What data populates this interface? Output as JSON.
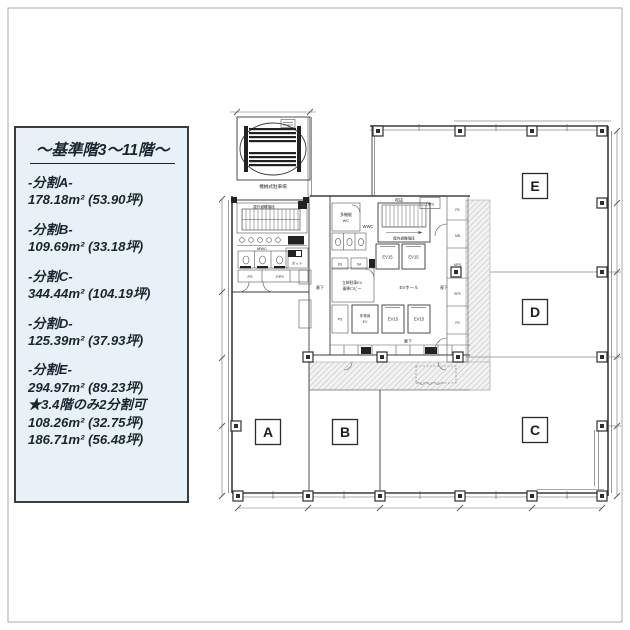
{
  "legend": {
    "title": "～基準階3～11階～",
    "items": [
      {
        "name": "-分割A-",
        "area": "178.18m² (53.90坪)"
      },
      {
        "name": "-分割B-",
        "area": "109.69m² (33.18坪)"
      },
      {
        "name": "-分割C-",
        "area": "344.44m² (104.19坪)"
      },
      {
        "name": "-分割D-",
        "area": "125.39m² (37.93坪)"
      },
      {
        "name": "-分割E-",
        "area": "294.97m² (89.23坪)",
        "note": "★3.4階のみ2分割可",
        "area2": "108.26m² (32.75坪)",
        "area3": "186.71m² (56.48坪)"
      }
    ]
  },
  "floorplan": {
    "sections": [
      {
        "label": "A"
      },
      {
        "label": "B"
      },
      {
        "label": "C"
      },
      {
        "label": "D"
      },
      {
        "label": "E"
      }
    ],
    "labels": {
      "parking": "機械式駐車場",
      "outdoor_stairs": "屋外避難階段",
      "indoor_stairs": "屋内避難階段",
      "void": "吹抜",
      "dps": "DPS",
      "mwc": "MWC",
      "wwc": "WWC",
      "accessible_wc_1": "多機能",
      "accessible_wc_2": "WC",
      "pantry": "ポット",
      "ps_a": "PS",
      "eps": "EPS",
      "ev_upper_left": "EV15",
      "ev_upper_right": "EV15",
      "ev_lower_left": "EV15",
      "ev_lower_right": "EV15",
      "ev_hall": "EVホール",
      "lobby_1": "立体駐車EV",
      "lobby_2": "乗降ロビー",
      "emergency_1": "非常用",
      "emergency_2": "EV",
      "ps_core": "PS",
      "ds": "DS",
      "oa": "OA",
      "corridor_west": "廊下",
      "corridor_east": "廊下",
      "corridor_south": "廊下",
      "shaft_1": "PS",
      "shaft_2": "MB",
      "shaft_3": "MPS",
      "shaft_4": "SPS",
      "shaft_5": "PS"
    }
  }
}
